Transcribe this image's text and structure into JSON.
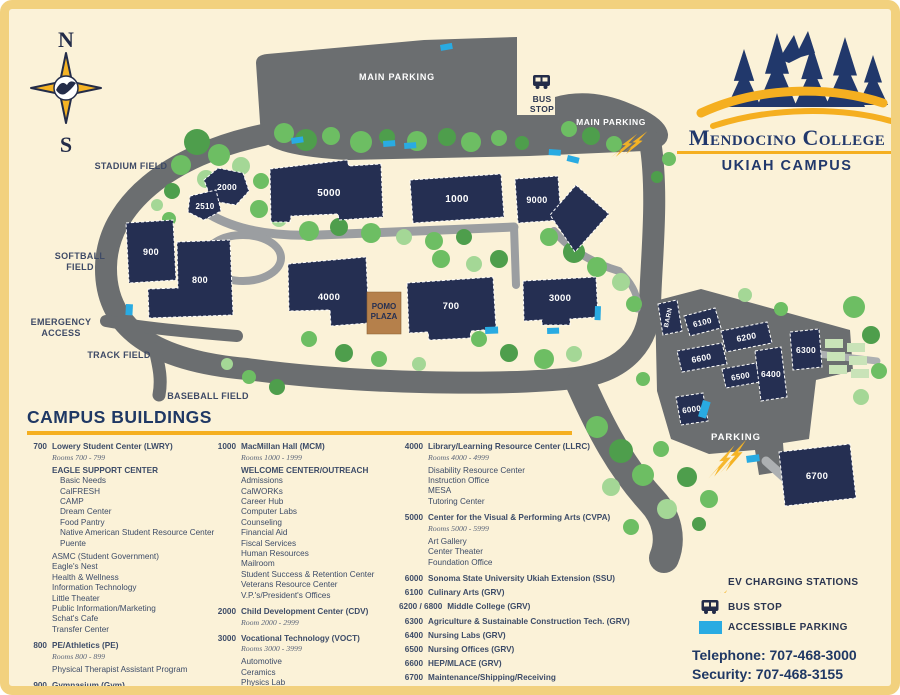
{
  "logo": {
    "name": "Mendocino College",
    "campus": "UKIAH CAMPUS"
  },
  "compass": {
    "north": "N",
    "south": "S"
  },
  "map": {
    "labels": [
      {
        "id": "main-parking-top",
        "lines": [
          "MAIN PARKING"
        ],
        "x": 388,
        "y": 71,
        "c": "#FFFFFF",
        "fs": 9,
        "ls": 0.8
      },
      {
        "id": "bus-stop",
        "lines": [
          "BUS",
          "STOP"
        ],
        "x": 533,
        "y": 93,
        "c": "#2A3550",
        "fs": 8.5,
        "ls": 0.3,
        "lh": 10
      },
      {
        "id": "main-parking-right",
        "lines": [
          "MAIN PARKING"
        ],
        "x": 602,
        "y": 116,
        "c": "#FFFFFF",
        "fs": 8.5,
        "ls": 0.6
      },
      {
        "id": "stadium-field",
        "lines": [
          "STADIUM FIELD"
        ],
        "x": 122,
        "y": 160,
        "c": "#3E4A66",
        "fs": 9,
        "ls": 0.3
      },
      {
        "id": "softball-field",
        "lines": [
          "SOFTBALL",
          "FIELD"
        ],
        "x": 71,
        "y": 250,
        "c": "#3E4A66",
        "fs": 9,
        "ls": 0.3,
        "lh": 11
      },
      {
        "id": "emergency-access",
        "lines": [
          "EMERGENCY",
          "ACCESS"
        ],
        "x": 52,
        "y": 316,
        "c": "#3E4A66",
        "fs": 9,
        "ls": 0.3,
        "lh": 11
      },
      {
        "id": "track-field",
        "lines": [
          "TRACK FIELD"
        ],
        "x": 110,
        "y": 349,
        "c": "#3E4A66",
        "fs": 9,
        "ls": 0.3
      },
      {
        "id": "baseball-field",
        "lines": [
          "BASEBALL FIELD"
        ],
        "x": 199,
        "y": 390,
        "c": "#3E4A66",
        "fs": 9,
        "ls": 0.3
      },
      {
        "id": "parking-east",
        "lines": [
          "PARKING"
        ],
        "x": 727,
        "y": 431,
        "c": "#FFFFFF",
        "fs": 9.5,
        "ls": 1
      }
    ],
    "buildings": [
      {
        "id": "5000",
        "label": "5000",
        "points": "261,160 338,151 340,157 372,155 374,208 330,211 329,205 282,207 281,213 262,213",
        "lx": 320,
        "ly": 187,
        "fs": 10
      },
      {
        "id": "2000",
        "label": "2000",
        "points": "209,159 234,164 240,182 227,196 203,192 195,171",
        "lx": 218,
        "ly": 181,
        "fs": 8.5
      },
      {
        "id": "2510",
        "label": "2510",
        "points": "181,187 207,181 212,202 195,211 179,203",
        "lx": 196,
        "ly": 200,
        "fs": 8
      },
      {
        "id": "1000",
        "label": "1000",
        "points": "401,171 492,165 495,208 404,214",
        "lx": 448,
        "ly": 193,
        "fs": 10
      },
      {
        "id": "9000",
        "label": "9000",
        "points": "506,170 549,167 552,211 509,214",
        "lx": 528,
        "ly": 194,
        "fs": 9
      },
      {
        "id": "9000-annex",
        "label": "",
        "points": "567,176 600,205 566,243 541,206",
        "lx": 0,
        "ly": 0,
        "fs": 0
      },
      {
        "id": "900",
        "label": "900",
        "points": "117,214 164,211 167,271 120,274",
        "lx": 142,
        "ly": 246,
        "fs": 9
      },
      {
        "id": "800",
        "label": "800",
        "points": "168,233 221,231 224,306 140,309 139,280 169,279",
        "lx": 191,
        "ly": 274,
        "fs": 9
      },
      {
        "id": "4000",
        "label": "4000",
        "points": "279,255 357,248 360,314 322,317 321,301 280,302",
        "lx": 320,
        "ly": 291,
        "fs": 9.5
      },
      {
        "id": "700",
        "label": "700",
        "points": "398,274 484,268 487,320 462,322 461,329 420,331 419,323 400,324",
        "lx": 442,
        "ly": 300,
        "fs": 9.5
      },
      {
        "id": "3000",
        "label": "3000",
        "points": "514,272 587,268 589,308 561,310 561,316 533,316 533,311 515,312",
        "lx": 551,
        "ly": 292,
        "fs": 9.5
      },
      {
        "id": "barn",
        "label": "BARN",
        "points": "649,295 668,291 673,322 654,326",
        "lx": 661,
        "ly": 309,
        "fs": 6.5,
        "lr": -78
      },
      {
        "id": "6100",
        "label": "6100",
        "points": "675,307 706,299 712,319 681,327",
        "lx": 694,
        "ly": 316,
        "fs": 8,
        "lr": -14
      },
      {
        "id": "6200",
        "label": "6200",
        "points": "712,322 758,313 763,334 717,343",
        "lx": 738,
        "ly": 331,
        "fs": 8.5,
        "lr": -11
      },
      {
        "id": "6300",
        "label": "6300",
        "points": "781,323 810,320 813,358 784,361",
        "lx": 797,
        "ly": 344,
        "fs": 8.5
      },
      {
        "id": "6600",
        "label": "6600",
        "points": "668,342 713,334 718,355 673,363",
        "lx": 693,
        "ly": 352,
        "fs": 8.5,
        "lr": -11
      },
      {
        "id": "6500",
        "label": "6500",
        "points": "713,360 747,354 751,373 717,379",
        "lx": 732,
        "ly": 370,
        "fs": 8,
        "lr": -10
      },
      {
        "id": "6400",
        "label": "6400",
        "points": "746,342 772,338 778,388 752,392",
        "lx": 762,
        "ly": 368,
        "fs": 8.5
      },
      {
        "id": "6000",
        "label": "6000",
        "points": "667,388 694,384 699,412 672,416",
        "lx": 683,
        "ly": 403,
        "fs": 8,
        "lr": -8
      },
      {
        "id": "6700",
        "label": "6700",
        "points": "770,443 841,435 847,489 776,497",
        "lx": 808,
        "ly": 470,
        "fs": 9.5
      },
      {
        "id": "pomo-plaza",
        "type": "plaza",
        "label": "POMO|PLAZA",
        "points": "358,283 392,283 392,325 358,325",
        "lx": 375,
        "ly": 300,
        "fs": 8
      }
    ],
    "accessible_spots": [
      [
        282,
        129,
        12,
        6,
        -8
      ],
      [
        374,
        132,
        12,
        6,
        -4
      ],
      [
        395,
        134,
        12,
        6,
        -4
      ],
      [
        431,
        36,
        12,
        6,
        -10
      ],
      [
        540,
        140,
        12,
        6,
        4
      ],
      [
        559,
        146,
        12,
        6,
        14
      ],
      [
        117,
        295,
        7,
        11,
        3
      ],
      [
        476,
        318,
        13,
        7,
        -2
      ],
      [
        586,
        297,
        6,
        14,
        2
      ],
      [
        538,
        319,
        12,
        6,
        -2
      ],
      [
        694,
        391,
        8,
        17,
        17
      ],
      [
        737,
        447,
        13,
        7,
        -8
      ]
    ],
    "ev_bolts": [
      [
        612,
        122,
        1.25,
        6
      ],
      [
        706,
        436,
        1.5,
        -4
      ]
    ],
    "bus_stops": [
      [
        524,
        66,
        1
      ]
    ]
  },
  "directory": {
    "title": "CAMPUS BUILDINGS",
    "columns": [
      [
        {
          "num": "700",
          "name": "Lowery Student Center (LWRY)",
          "rooms": "Rooms 700 - 799",
          "sections": [
            {
              "heading": "EAGLE SUPPORT CENTER",
              "indent": 8,
              "items": [
                "Basic Needs",
                "CalFRESH",
                "CAMP",
                "Dream Center",
                "Food Pantry",
                "Native American Student Resource Center",
                "Puente"
              ]
            },
            {
              "items": [
                "ASMC (Student Government)",
                "Eagle's Nest",
                "Health & Wellness",
                "Information Technology",
                "Little Theater",
                "Public Information/Marketing",
                "Schat's Cafe",
                "Transfer Center"
              ]
            }
          ]
        },
        {
          "num": "800",
          "name": "PE/Athletics (PE)",
          "rooms": "Rooms 800 - 899",
          "sections": [
            {
              "items": [
                "Physical Therapist Assistant Program"
              ]
            }
          ]
        },
        {
          "num": "900",
          "name": "Gymnasium (Gym)"
        }
      ],
      [
        {
          "num": "1000",
          "name": "MacMillan Hall (MCM)",
          "rooms": "Rooms 1000 - 1999",
          "sections": [
            {
              "heading": "WELCOME CENTER/OUTREACH",
              "items": [
                "Admissions",
                "CalWORKs",
                "Career Hub",
                "Computer Labs",
                "Counseling",
                "Financial Aid",
                "Fiscal Services",
                "Human Resources",
                "Mailroom",
                "Student Success & Retention Center",
                "Veterans Resource Center",
                "V.P.'s/President's Offices"
              ]
            }
          ]
        },
        {
          "num": "2000",
          "name": "Child Development Center (CDV)",
          "rooms": "Room 2000 - 2999"
        },
        {
          "num": "3000",
          "name": "Vocational Technology (VOCT)",
          "rooms": "Rooms 3000 - 3999",
          "sections": [
            {
              "items": [
                "Automotive",
                "Ceramics",
                "Physics Lab"
              ]
            }
          ]
        }
      ],
      [
        {
          "num": "4000",
          "name": "Library/Learning Resource Center (LLRC)",
          "rooms": "Rooms 4000 - 4999",
          "sections": [
            {
              "items": [
                "Disability Resource Center",
                "Instruction Office",
                "MESA",
                "Tutoring Center"
              ]
            }
          ]
        },
        {
          "num": "5000",
          "name": "Center for the Visual & Performing Arts (CVPA)",
          "rooms": "Rooms 5000 - 5999",
          "sections": [
            {
              "items": [
                "Art Gallery",
                "Center Theater",
                "Foundation Office"
              ]
            }
          ]
        },
        {
          "num": "6000",
          "name": "Sonoma State University Ukiah Extension (SSU)"
        },
        {
          "num": "6100",
          "name": "Culinary Arts (GRV)"
        },
        {
          "num": "6200 / 6800",
          "name": "Middle College (GRV)"
        },
        {
          "num": "6300",
          "name": "Agriculture & Sustainable Construction Tech. (GRV)"
        },
        {
          "num": "6400",
          "name": "Nursing Labs (GRV)"
        },
        {
          "num": "6500",
          "name": "Nursing Offices (GRV)"
        },
        {
          "num": "6600",
          "name": "HEP/MLACE (GRV)"
        },
        {
          "num": "6700",
          "name": "Maintenance/Shipping/Receiving"
        },
        {
          "num": "9000",
          "name": "Science Complex (SCNC)"
        }
      ]
    ]
  },
  "legend": {
    "items": [
      {
        "icon": "ev-bolt",
        "label": "EV CHARGING STATIONS"
      },
      {
        "icon": "bus",
        "label": "BUS STOP"
      },
      {
        "icon": "accessible",
        "label": "ACCESSIBLE PARKING"
      }
    ],
    "telephone": "Telephone: 707-468-3000",
    "security": "Security: 707-468-3155"
  }
}
